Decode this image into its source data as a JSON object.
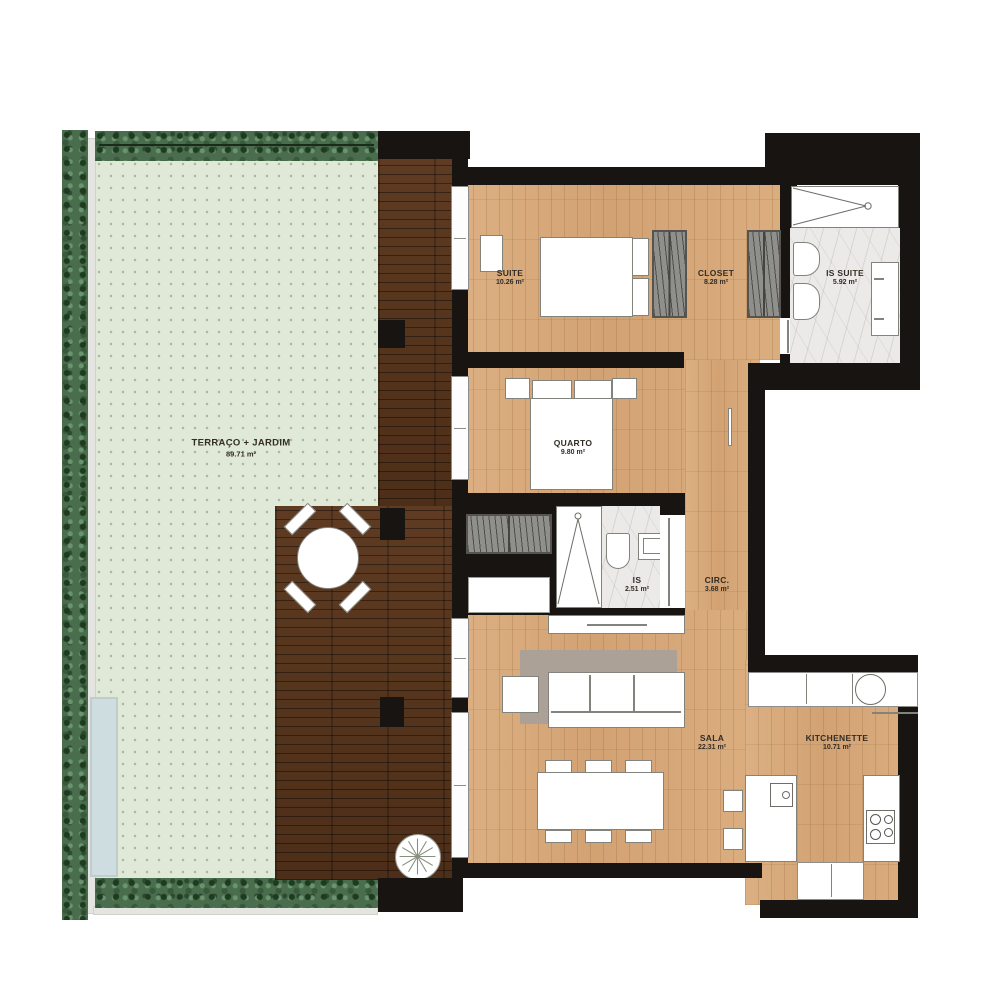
{
  "rooms": {
    "terrace": {
      "name": "TERRAÇO + JARDIM",
      "area": "89.71 m²"
    },
    "suite": {
      "name": "SUITE",
      "area": "10.26 m²"
    },
    "closet": {
      "name": "CLOSET",
      "area": "8.28 m²"
    },
    "is_suite": {
      "name": "IS SUITE",
      "area": "5.92 m²"
    },
    "quarto": {
      "name": "QUARTO",
      "area": "9.80 m²"
    },
    "is": {
      "name": "IS",
      "area": "2.51 m²"
    },
    "circ": {
      "name": "CIRC.",
      "area": "3.68 m²"
    },
    "sala": {
      "name": "SALA",
      "area": "22.31 m²"
    },
    "kitchenette": {
      "name": "KITCHENETTE",
      "area": "10.71 m²"
    }
  },
  "colors": {
    "wall": "#171411",
    "wood_floor": "#d8aa7c",
    "deck": "#55341d",
    "terrace_green": "#e0e8d7",
    "hedge_green": "#4a6e4d",
    "marble": "#eceae8",
    "rug": "#a8a199",
    "planter_blue": "#cddde0"
  },
  "icons": {
    "tree": "tree-top-view-icon",
    "sink": "round-sink-icon",
    "cooktop": "four-burner-cooktop-icon",
    "shower": "shower-drain-icon"
  }
}
